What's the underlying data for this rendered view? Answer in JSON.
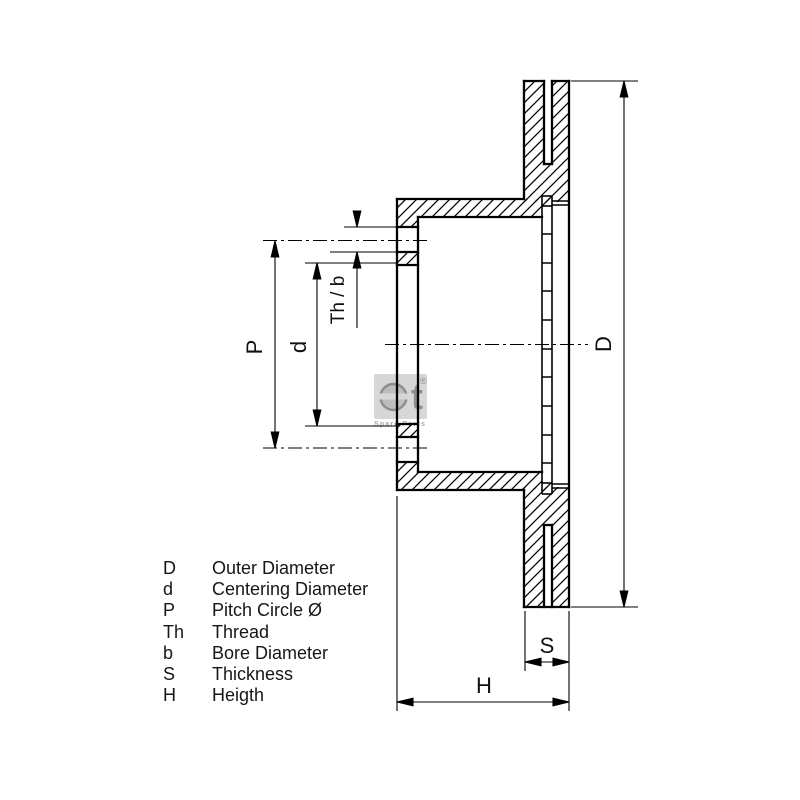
{
  "drawing": {
    "type": "brake-disc-cross-section",
    "labels": {
      "outer_diameter": "D",
      "centering_diameter": "d",
      "pitch_circle": "P",
      "thread_bore": "Th / b",
      "thickness": "S",
      "height": "H"
    },
    "legend": {
      "rows": [
        {
          "symbol": "D",
          "description": "Outer Diameter"
        },
        {
          "symbol": "d",
          "description": "Centering Diameter"
        },
        {
          "symbol": "P",
          "description": "Pitch Circle Ø"
        },
        {
          "symbol": "Th",
          "description": "Thread"
        },
        {
          "symbol": "b",
          "description": "Bore Diameter"
        },
        {
          "symbol": "S",
          "description": "Thickness"
        },
        {
          "symbol": "H",
          "description": "Heigth"
        }
      ]
    },
    "logo": {
      "letter": "t",
      "registered": "®",
      "subtext": "Spare Parts"
    },
    "colors": {
      "line": "#000000",
      "text": "#161616",
      "logo_gray": "#8d8d8d",
      "logo_badge": "#d7d7d7"
    }
  }
}
